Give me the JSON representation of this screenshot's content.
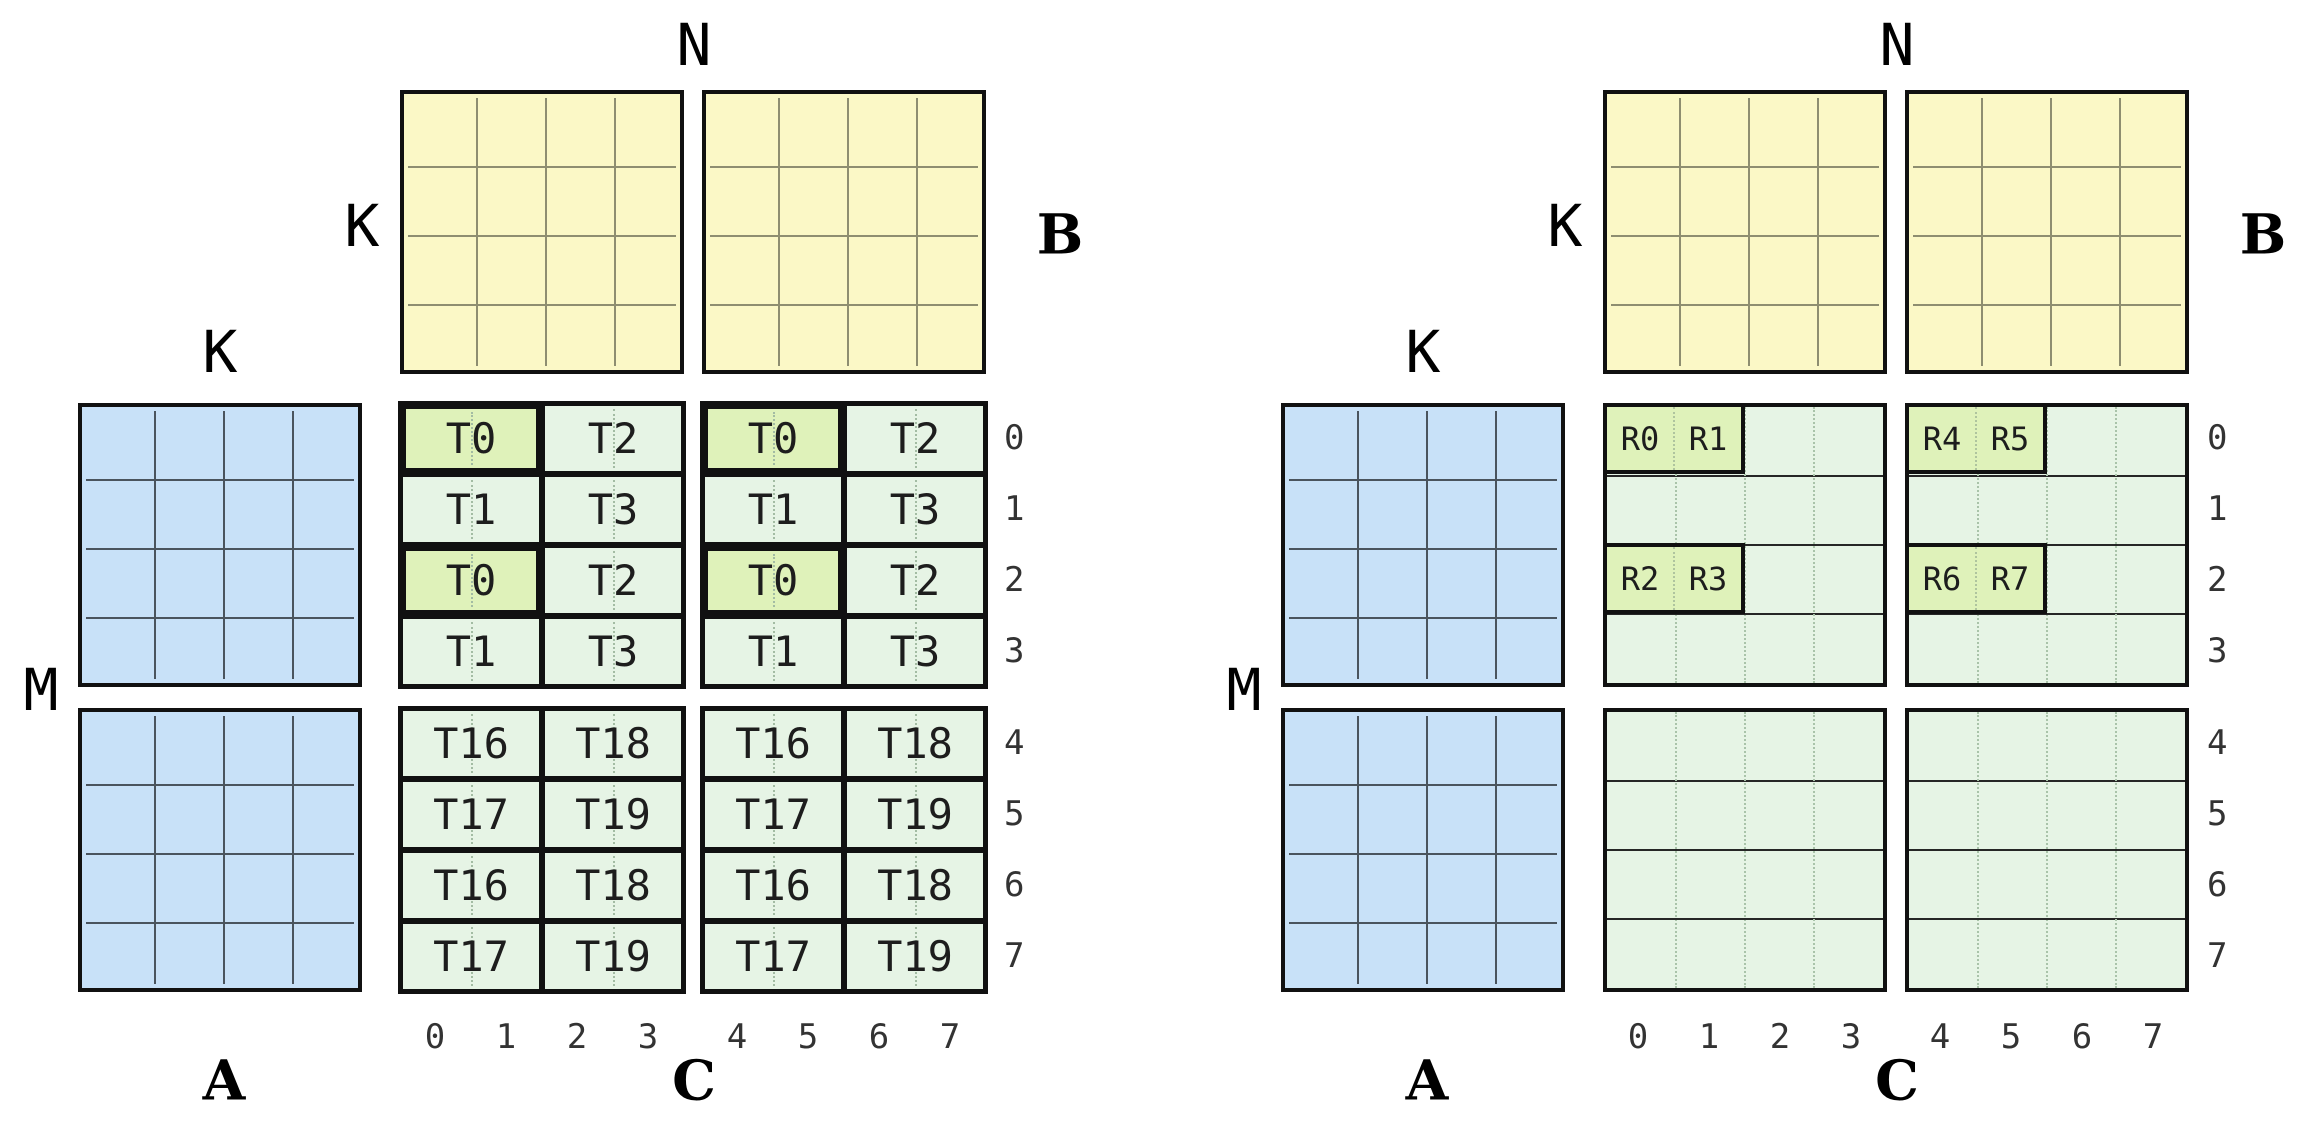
{
  "colors": {
    "matrix_a_fill": "#C8E1F8",
    "matrix_b_fill": "#FBF8C6",
    "matrix_c_fill": "#E6F4E5",
    "highlight_fill": "#DFF2BA",
    "block_border": "#111111",
    "a_grid_line": "#4A545E",
    "b_grid_line": "#8E8E70"
  },
  "diagrams": [
    {
      "side": "left",
      "labels": {
        "n": "N",
        "k_beside_b": "K",
        "b": "B",
        "k_above_a": "K",
        "m": "M",
        "a": "A",
        "c": "C"
      },
      "row_indices": [
        "0",
        "1",
        "2",
        "3",
        "4",
        "5",
        "6",
        "7"
      ],
      "col_indices": [
        "0",
        "1",
        "2",
        "3",
        "4",
        "5",
        "6",
        "7"
      ],
      "c_style": "thread-tiles",
      "c_blocks": [
        {
          "pos": "top-left",
          "tiles": [
            [
              "T0",
              "T2"
            ],
            [
              "T1",
              "T3"
            ],
            [
              "T0",
              "T2"
            ],
            [
              "T1",
              "T3"
            ]
          ],
          "highlighted": [
            [
              0,
              0
            ],
            [
              2,
              0
            ]
          ]
        },
        {
          "pos": "top-right",
          "tiles": [
            [
              "T0",
              "T2"
            ],
            [
              "T1",
              "T3"
            ],
            [
              "T0",
              "T2"
            ],
            [
              "T1",
              "T3"
            ]
          ],
          "highlighted": [
            [
              0,
              0
            ],
            [
              2,
              0
            ]
          ]
        },
        {
          "pos": "bottom-left",
          "tiles": [
            [
              "T16",
              "T18"
            ],
            [
              "T17",
              "T19"
            ],
            [
              "T16",
              "T18"
            ],
            [
              "T17",
              "T19"
            ]
          ],
          "highlighted": []
        },
        {
          "pos": "bottom-right",
          "tiles": [
            [
              "T16",
              "T18"
            ],
            [
              "T17",
              "T19"
            ],
            [
              "T16",
              "T18"
            ],
            [
              "T17",
              "T19"
            ]
          ],
          "highlighted": []
        }
      ]
    },
    {
      "side": "right",
      "labels": {
        "n": "N",
        "k_beside_b": "K",
        "b": "B",
        "k_above_a": "K",
        "m": "M",
        "a": "A",
        "c": "C"
      },
      "row_indices": [
        "0",
        "1",
        "2",
        "3",
        "4",
        "5",
        "6",
        "7"
      ],
      "col_indices": [
        "0",
        "1",
        "2",
        "3",
        "4",
        "5",
        "6",
        "7"
      ],
      "c_style": "register-boxes",
      "c_blocks": [
        {
          "pos": "top-left",
          "boxes": [
            {
              "row": 0,
              "cells": [
                "R0",
                "R1"
              ]
            },
            {
              "row": 2,
              "cells": [
                "R2",
                "R3"
              ]
            }
          ]
        },
        {
          "pos": "top-right",
          "boxes": [
            {
              "row": 0,
              "cells": [
                "R4",
                "R5"
              ]
            },
            {
              "row": 2,
              "cells": [
                "R6",
                "R7"
              ]
            }
          ]
        },
        {
          "pos": "bottom-left",
          "boxes": []
        },
        {
          "pos": "bottom-right",
          "boxes": []
        }
      ]
    }
  ]
}
